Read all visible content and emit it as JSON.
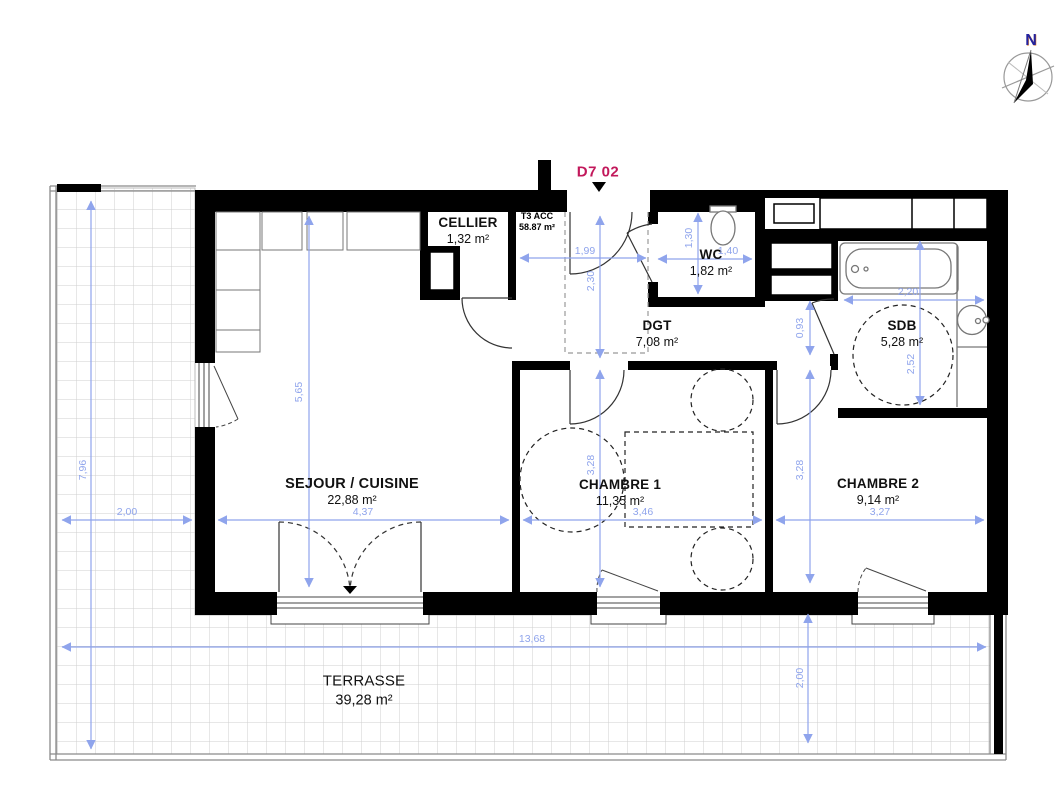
{
  "plan": {
    "unit": {
      "id": "D7 02",
      "type": "T3 ACC",
      "total_area": "58.87 m²"
    },
    "compass": {
      "north": "N"
    },
    "rooms": {
      "cellier": {
        "name": "CELLIER",
        "area": "1,32 m²"
      },
      "wc": {
        "name": "WC",
        "area": "1,82 m²"
      },
      "dgt": {
        "name": "DGT",
        "area": "7,08 m²"
      },
      "sdb": {
        "name": "SDB",
        "area": "5,28 m²"
      },
      "sejour": {
        "name": "SEJOUR / CUISINE",
        "area": "22,88 m²"
      },
      "chambre1": {
        "name": "CHAMBRE 1",
        "area": "11,35 m²"
      },
      "chambre2": {
        "name": "CHAMBRE 2",
        "area": "9,14 m²"
      },
      "terrasse": {
        "name": "TERRASSE",
        "area": "39,28 m²"
      }
    },
    "dims": {
      "sejour_w": "4,37",
      "sejour_h": "5,65",
      "terrace_w": "2,00",
      "terrace_h": "7,96",
      "terrace_l": "13,68",
      "terrace_d": "2,00",
      "entry_w": "1,99",
      "entry_d": "2,30",
      "wc_h": "1,30",
      "wc_w": "1,40",
      "sdb_w": "2,20",
      "sdb_h": "2,52",
      "sdb_off": "0,93",
      "ch1_w": "3,46",
      "ch1_h": "3,28",
      "ch2_w": "3,27",
      "ch2_h": "3,28"
    },
    "colors": {
      "dimension": "#8fa4ec",
      "unit_label": "#c2185b",
      "wall": "#000000",
      "grid": "#cfcfcf"
    }
  }
}
